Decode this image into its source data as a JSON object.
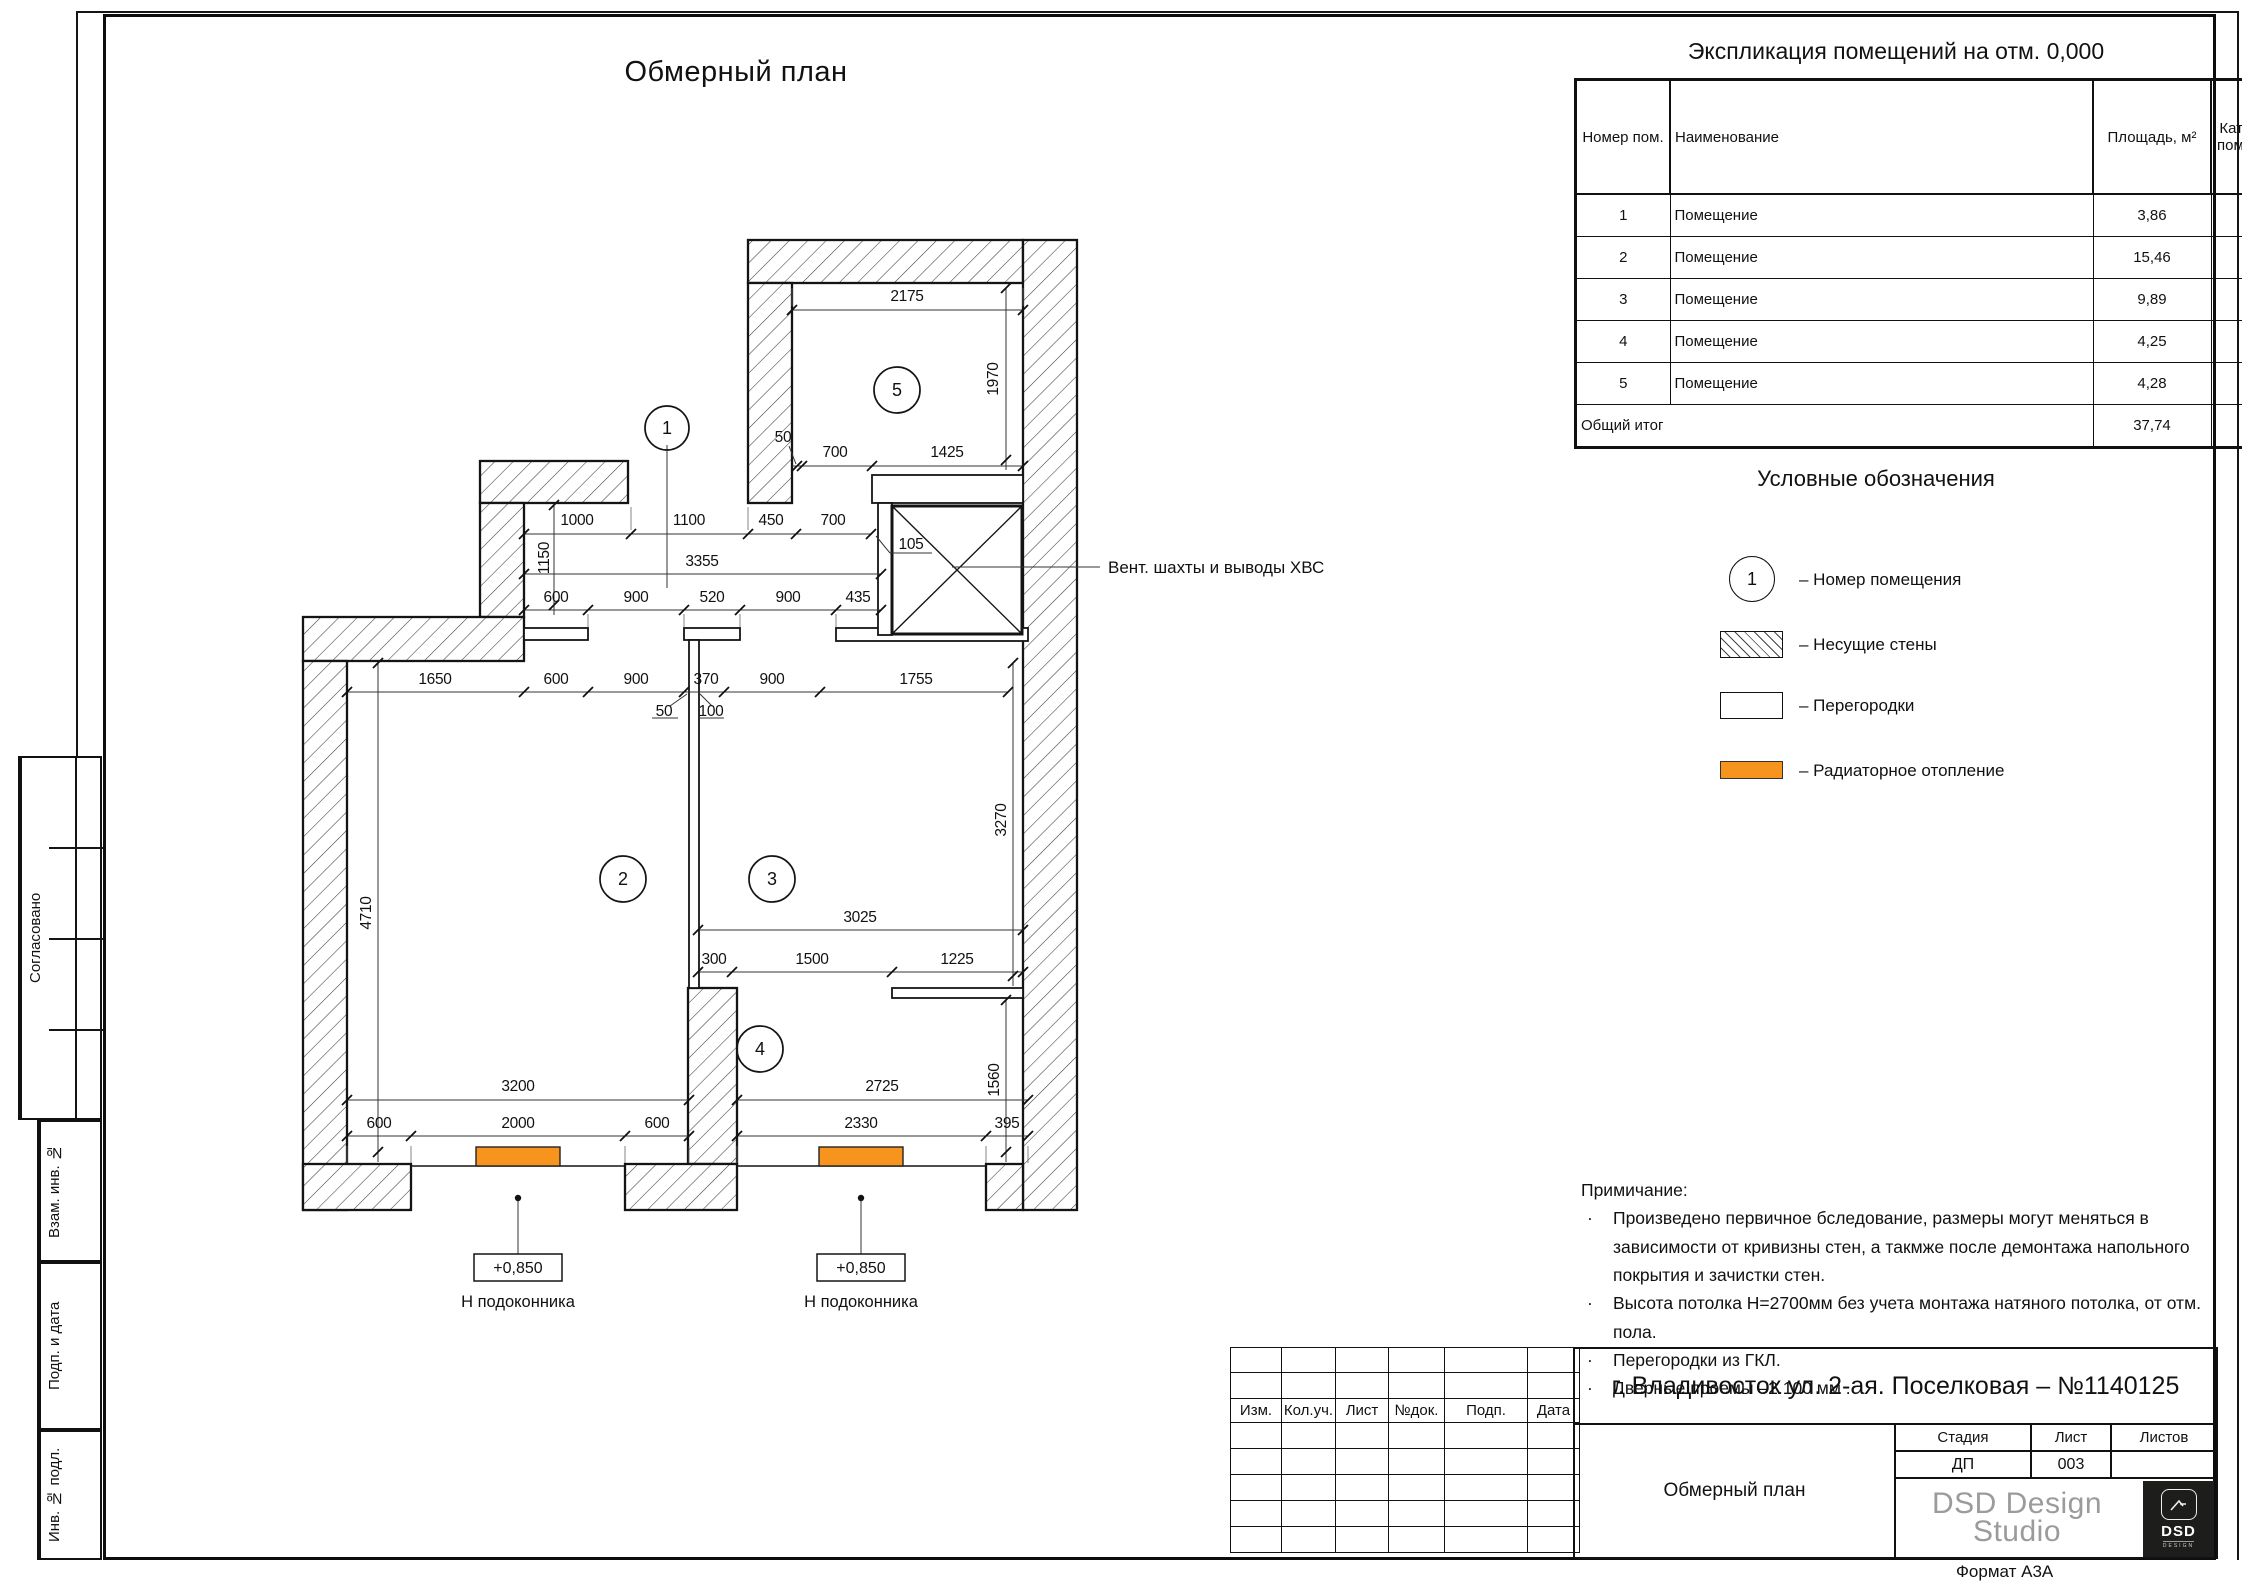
{
  "sheet": {
    "title": "Обмерный план",
    "format": "Формат А3А"
  },
  "colors": {
    "radiator": "#F7941E",
    "logo_bg": "#1D1D1B",
    "logo_text": "#9B9B9B"
  },
  "explication": {
    "title": "Экспликация помещений на отм. 0,000",
    "headers": {
      "number": "Номер пом.",
      "name": "Наименование",
      "area": "Площадь, м²",
      "cat": "Кат. пом."
    },
    "rows": [
      {
        "num": "1",
        "name": "Помещение",
        "area": "3,86",
        "cat": ""
      },
      {
        "num": "2",
        "name": "Помещение",
        "area": "15,46",
        "cat": ""
      },
      {
        "num": "3",
        "name": "Помещение",
        "area": "9,89",
        "cat": ""
      },
      {
        "num": "4",
        "name": "Помещение",
        "area": "4,25",
        "cat": ""
      },
      {
        "num": "5",
        "name": "Помещение",
        "area": "4,28",
        "cat": ""
      }
    ],
    "total_label": "Общий итог",
    "total_area": "37,74"
  },
  "legend": {
    "title": "Условные обозначения",
    "number_symbol": "1",
    "items": [
      {
        "label": "– Номер помещения"
      },
      {
        "label": "– Несущие стены"
      },
      {
        "label": "– Перегородки"
      },
      {
        "label": "– Радиаторное отопление"
      }
    ]
  },
  "notes": {
    "title": "Примичание:",
    "items": [
      "Произведено первичное бследование, размеры могут меняться в зависимости от кривизны стен, а такмже после демонтажа напольного покрытия и зачистки стен.",
      "Высота потолка Н=2700мм без учета монтажа натяного потолка, от отм. пола.",
      "Перегородки из ГКЛ.",
      "Дверные проемы –2.100 мм ."
    ]
  },
  "plan": {
    "rooms": [
      "1",
      "2",
      "3",
      "4",
      "5"
    ],
    "vent_label": "Вент. шахты и выводы ХВС",
    "sill_value": "+0,850",
    "sill_label": "Н подоконника",
    "dims": [
      "2175",
      "1970",
      "50",
      "700",
      "1425",
      "1000",
      "1100",
      "450",
      "700",
      "1150",
      "3355",
      "600",
      "900",
      "520",
      "900",
      "435",
      "105",
      "1650",
      "600",
      "900",
      "370",
      "900",
      "1755",
      "50",
      "100",
      "3270",
      "4710",
      "3025",
      "300",
      "1500",
      "1225",
      "3200",
      "2725",
      "600",
      "2000",
      "600",
      "2330",
      "395",
      "1560"
    ]
  },
  "stamp": {
    "object": "г. Владивосток ул. 2-ая. Поселковая – №1140125",
    "doc_title": "Обмерный план",
    "cols": [
      "Изм.",
      "Кол.уч.",
      "Лист",
      "№док.",
      "Подп.",
      "Дата"
    ],
    "stage_label": "Стадия",
    "sheet_label": "Лист",
    "sheets_label": "Листов",
    "stage": "ДП",
    "sheet_num": "003",
    "sheets": "",
    "logo_line1": "DSD Design",
    "logo_line2": "Studio",
    "logo_mark": "DSD",
    "logo_sub": "DESIGN"
  },
  "side_labels": [
    "Согласовано",
    "Взам. инв. №",
    "Подп. и дата",
    "Инв. № подл."
  ]
}
